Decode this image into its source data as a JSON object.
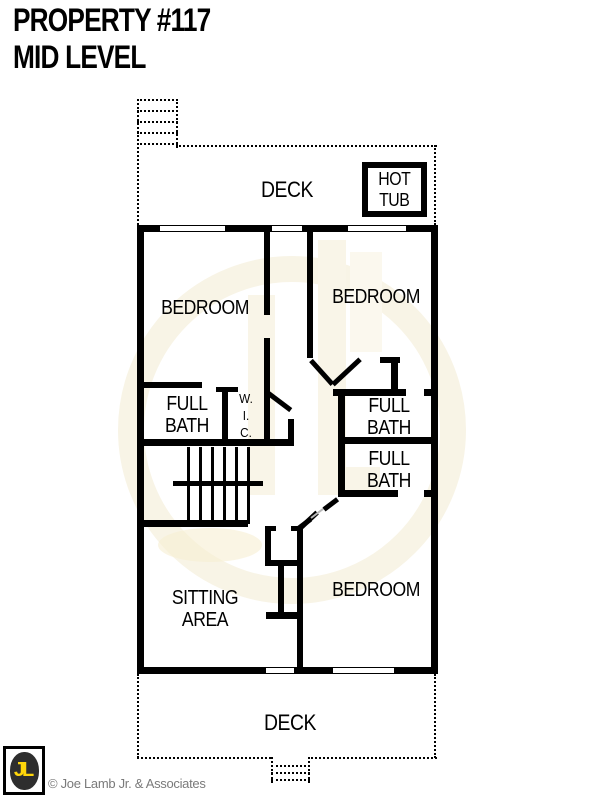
{
  "header": {
    "title_line1": "PROPERTY #117",
    "title_line2": "MID LEVEL"
  },
  "plan": {
    "deck_top": "DECK",
    "deck_bottom": "DECK",
    "hot_tub": "HOT\nTUB",
    "bedroom_left": "BEDROOM",
    "bedroom_right": "BEDROOM",
    "bedroom_bottom": "BEDROOM",
    "full_bath_left": "FULL\nBATH",
    "full_bath_right_upper": "FULL\nBATH",
    "full_bath_right_lower": "FULL\nBATH",
    "walk_in_closet": "W.\nI.\nC.",
    "sitting_area": "SITTING\nAREA"
  },
  "footer": {
    "logo_initials": "JL",
    "copyright": "© Joe Lamb Jr. & Associates"
  },
  "colors": {
    "wall_black": "#000000",
    "logo_yellow": "#ffd60a",
    "copyright_gray": "#7a7a7a",
    "watermark_cream": "#f8f4e6"
  }
}
